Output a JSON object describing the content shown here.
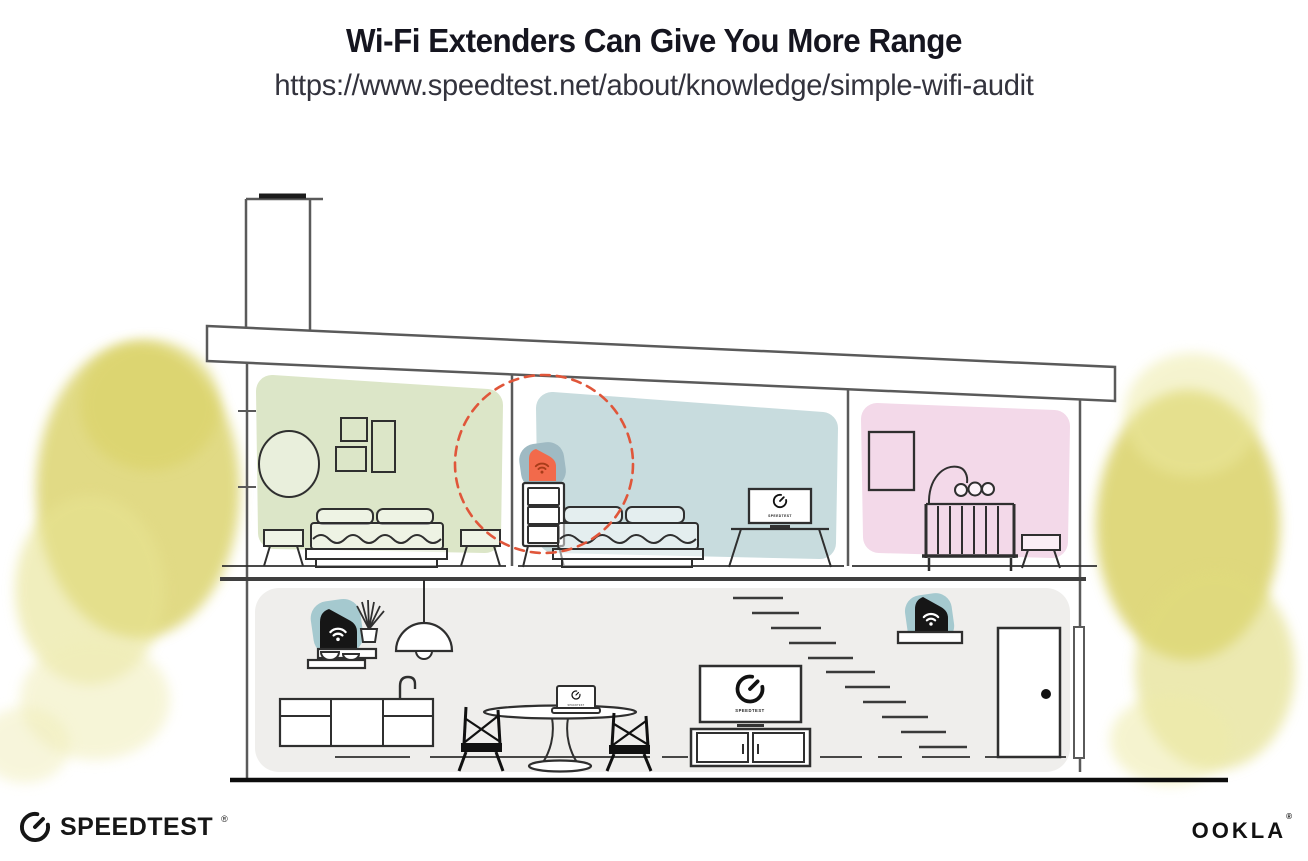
{
  "header": {
    "title": "Wi-Fi Extenders Can Give You More Range",
    "url": "https://www.speedtest.net/about/knowledge/simple-wifi-audit"
  },
  "footer": {
    "speedtest_wordmark": "SPEEDTEST",
    "speedtest_trademark": "®",
    "ookla_wordmark": "OOKLA",
    "ookla_trademark": "®"
  },
  "illustration": {
    "bedroom_tv_label": "SPEEDTEST",
    "living_room_tv_label": "SPEEDTEST",
    "laptop_label": "SPEEDTEST",
    "colors": {
      "green_bedroom_wall": "#dce6c8",
      "blue_bedroom_wall": "#c8dcde",
      "nursery_wall": "#f3d9e9",
      "downstairs_wall": "#efeeec",
      "foliage_yellow": "#dcd46f",
      "extender_highlight_orange": "#f26a4b",
      "extender_wifi_dark_orange": "#a83c19",
      "device_backdrop_teal": "#a5c9cf",
      "device_backdrop_slate": "#9fbac3",
      "device_black": "#161616",
      "range_circle_dashed": "#e0563a",
      "structure_line": "#5a5a5a",
      "furniture_line": "#2f2f2f"
    }
  }
}
